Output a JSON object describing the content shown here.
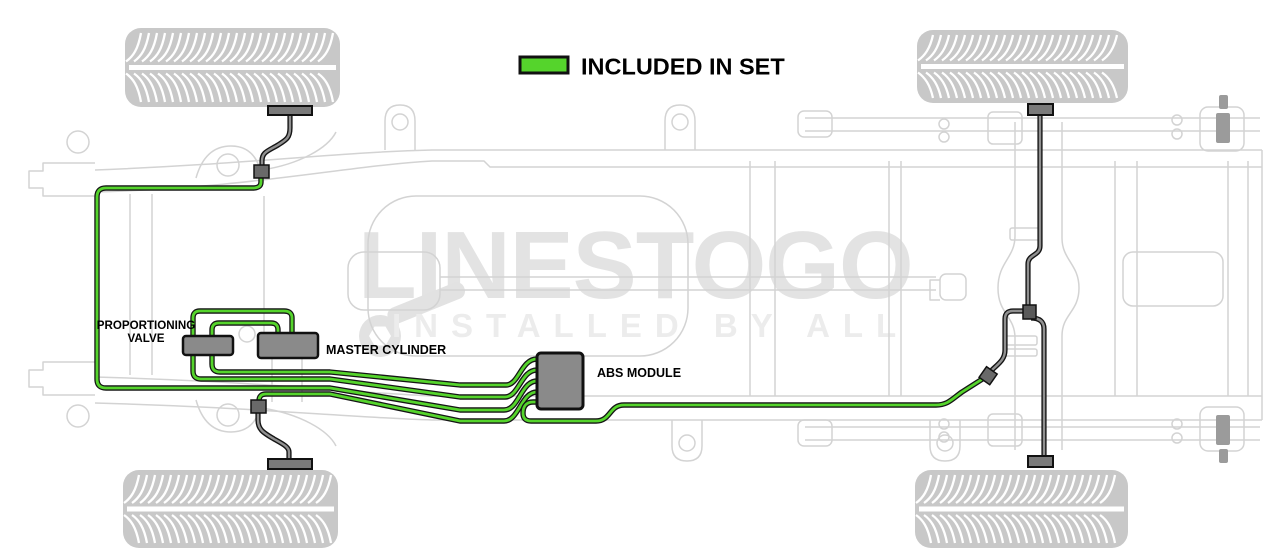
{
  "legend": {
    "label": "INCLUDED IN SET",
    "swatch_color": "#55d42c"
  },
  "component_labels": {
    "proportioning_valve_line1": "PROPORTIONING",
    "proportioning_valve_line2": "VALVE",
    "master_cylinder": "MASTER CYLINDER",
    "abs_module": "ABS MODULE"
  },
  "watermark": {
    "brand": "LINESTOGO",
    "tagline": "INSTALLED BY ALL"
  },
  "colors": {
    "included_line_green": "#55d42c",
    "line_outline_black": "#151515",
    "excluded_hose_gray": "#909090",
    "component_fill_gray": "#8a8a8a",
    "component_border": "#111111",
    "chassis_light_gray": "#d3d3d3",
    "tire_gray": "#c8c8c8",
    "watermark_gray": "#e3e3e3",
    "watermark_light_gray": "#ececec"
  },
  "diagram": {
    "labeled_components": [
      "PROPORTIONING VALVE",
      "MASTER CYLINDER",
      "ABS MODULE"
    ]
  }
}
